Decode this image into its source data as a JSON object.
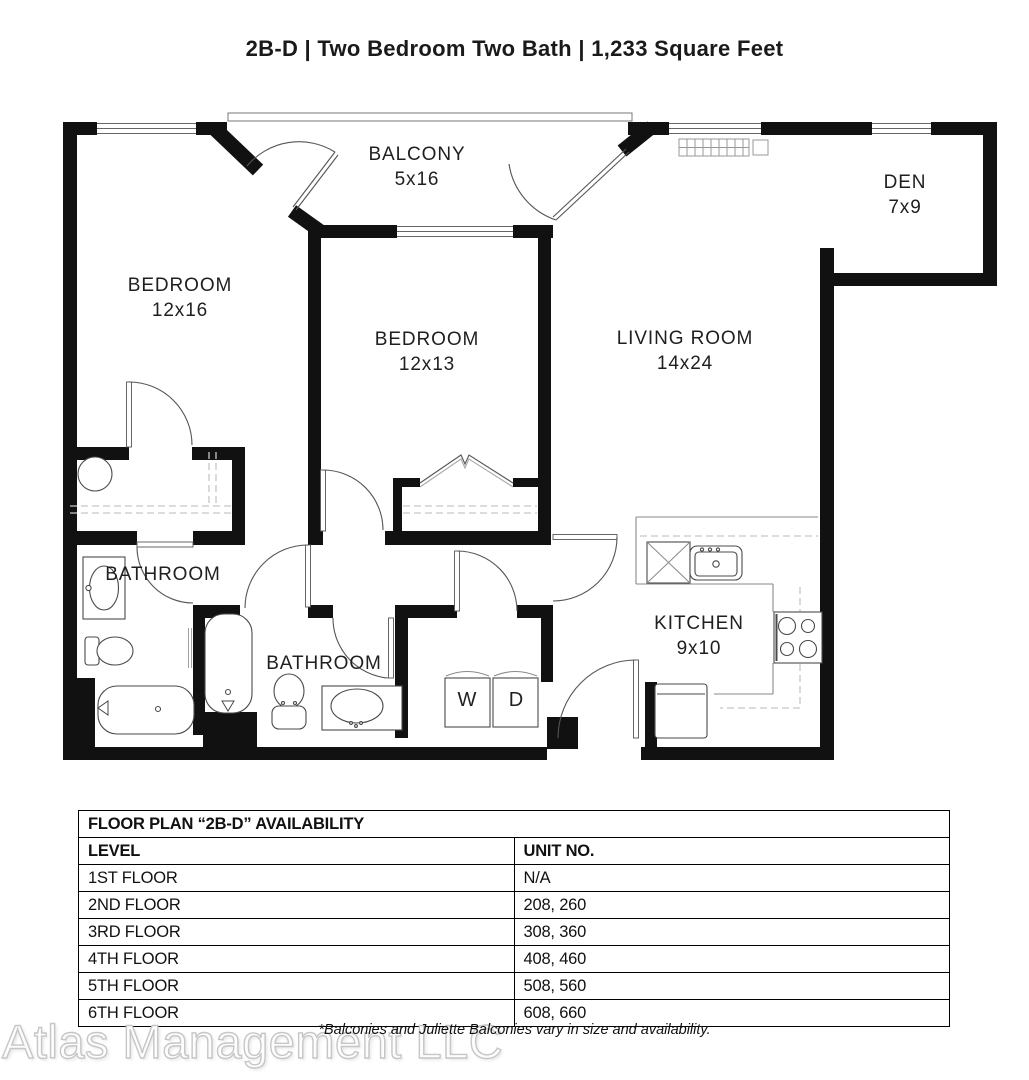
{
  "page_title": "2B-D | Two Bedroom Two Bath | 1,233 Square Feet",
  "floor_plan": {
    "rooms": {
      "balcony": {
        "label": "BALCONY",
        "dims": "5x16"
      },
      "den": {
        "label": "DEN",
        "dims": "7x9"
      },
      "bedroom_left": {
        "label": "BEDROOM",
        "dims": "12x16"
      },
      "bedroom_middle": {
        "label": "BEDROOM",
        "dims": "12x13"
      },
      "living_room": {
        "label": "LIVING ROOM",
        "dims": "14x24"
      },
      "bathroom_left": {
        "label": "BATHROOM"
      },
      "bathroom_middle": {
        "label": "BATHROOM"
      },
      "kitchen": {
        "label": "KITCHEN",
        "dims": "9x10"
      }
    },
    "appliances": {
      "washer": "W",
      "dryer": "D"
    }
  },
  "availability": {
    "title": "FLOOR PLAN “2B-D” AVAILABILITY",
    "columns": {
      "level": "LEVEL",
      "unit": "UNIT NO."
    },
    "rows": [
      {
        "level": "1ST FLOOR",
        "units": "N/A"
      },
      {
        "level": "2ND FLOOR",
        "units": "208, 260"
      },
      {
        "level": "3RD FLOOR",
        "units": "308, 360"
      },
      {
        "level": "4TH FLOOR",
        "units": "408, 460"
      },
      {
        "level": "5TH FLOOR",
        "units": "508, 560"
      },
      {
        "level": "6TH FLOOR",
        "units": "608, 660"
      }
    ]
  },
  "footnote": "*Balconies and Juliette Balconies vary in size and availability.",
  "watermark": "Atlas Management LLC"
}
